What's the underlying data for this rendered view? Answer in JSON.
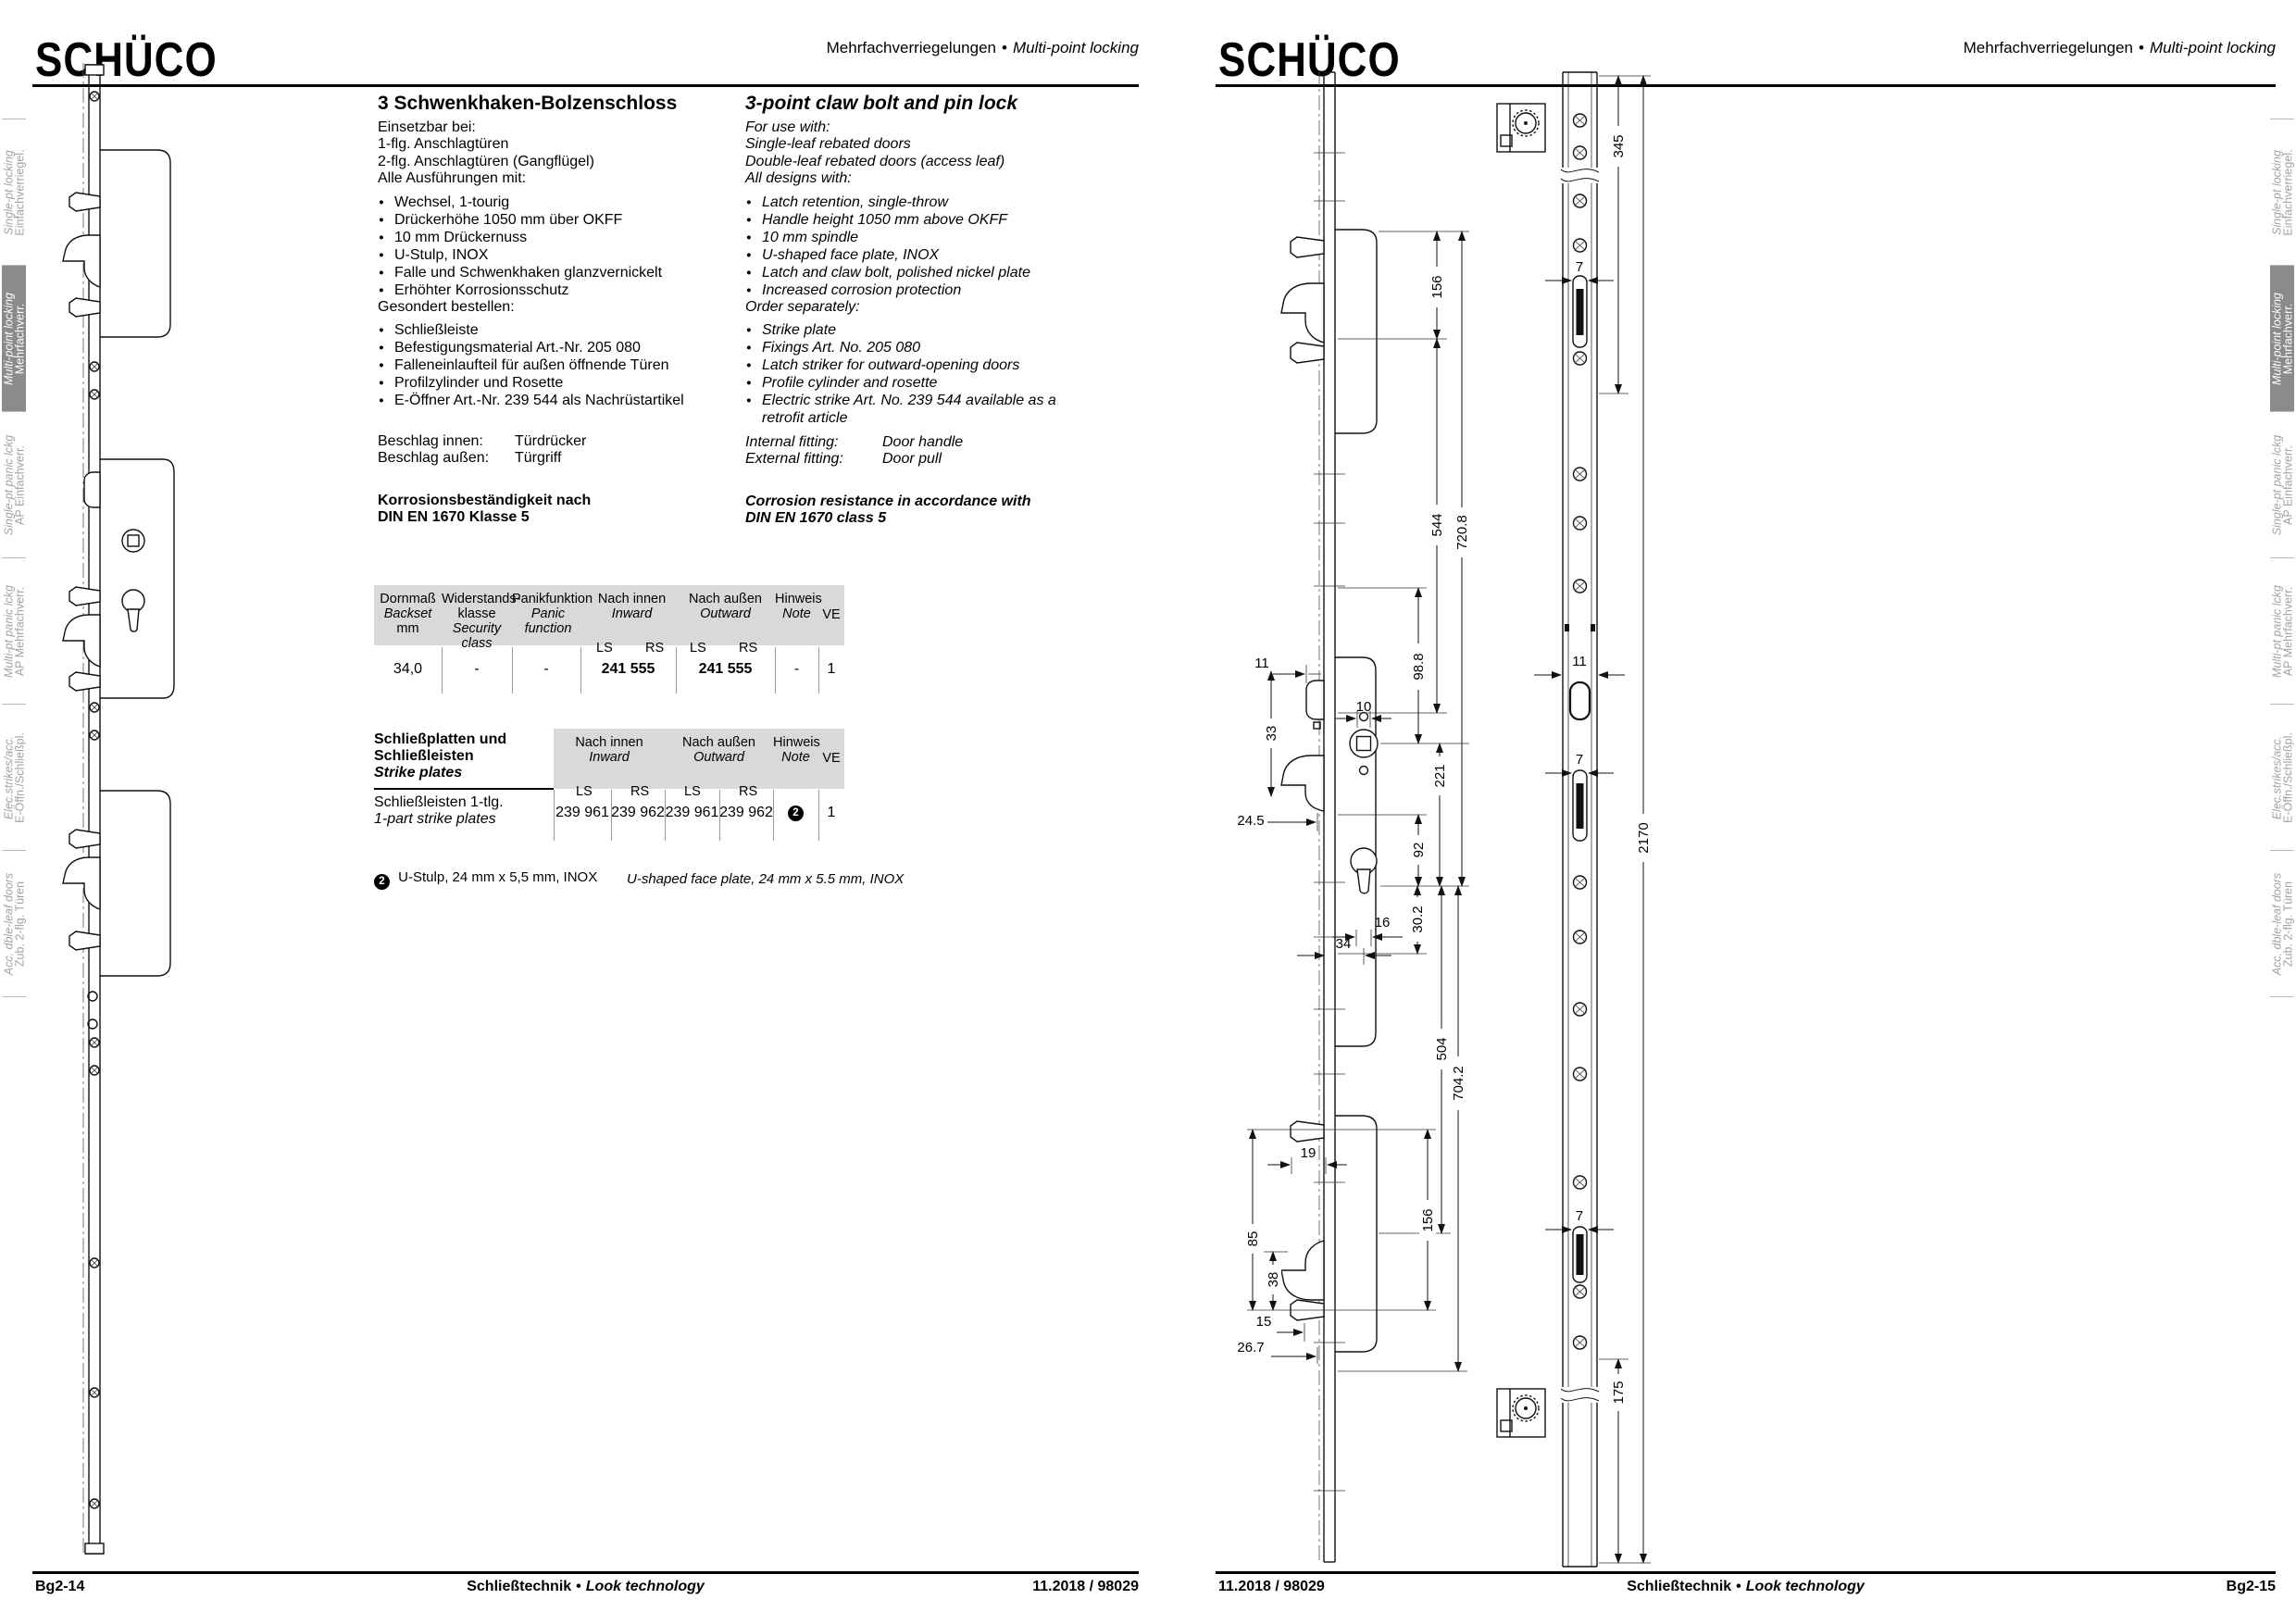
{
  "header": {
    "logo": "SCHÜCO",
    "subtitle_de": "Mehrfachverriegelungen",
    "sep": "•",
    "subtitle_en": "Multi-point locking"
  },
  "footer": {
    "page_left": "Bg2-14",
    "page_right": "Bg2-15",
    "center_de": "Schließtechnik",
    "sep": "•",
    "center_en": "Look technology",
    "code": "11.2018 / 98029"
  },
  "tabs": [
    {
      "en": "Single-pt locking",
      "de": "Einfachverriegel."
    },
    {
      "en": "Multi-point locking",
      "de": "Mehrfachverr."
    },
    {
      "en": "Single-pt panic lckg",
      "de": "AP Einfachverr."
    },
    {
      "en": "Multi-pt panic lckg",
      "de": "AP Mehrfachverr."
    },
    {
      "en": "Elec.strikes/acc.",
      "de": "E-Öffn./Schließpl."
    },
    {
      "en": "Acc. dble-leaf doors",
      "de": "Zub. 2-flg. Türen"
    }
  ],
  "product": {
    "de": {
      "title": "3 Schwenkhaken-Bolzenschloss",
      "intro": [
        "Einsetzbar bei:",
        "1-flg. Anschlagtüren",
        "2-flg. Anschlagtüren (Gangflügel)"
      ],
      "designs_heading": "Alle Ausführungen mit:",
      "designs": [
        "Wechsel, 1-tourig",
        "Drückerhöhe 1050 mm über OKFF",
        "10 mm Drückernuss",
        "U-Stulp, INOX",
        "Falle und Schwenkhaken glanzvernickelt",
        "Erhöhter Korrosionsschutz"
      ],
      "order_heading": "Gesondert bestellen:",
      "order": [
        "Schließleiste",
        "Befestigungsmaterial Art.-Nr. 205 080",
        "Falleneinlaufteil für außen öffnende Türen",
        "Profilzylinder und Rosette",
        "E-Öffner Art.-Nr. 239 544 als Nachrüstartikel"
      ],
      "fittings": [
        {
          "label": "Beschlag innen:",
          "value": "Türdrücker"
        },
        {
          "label": "Beschlag außen:",
          "value": "Türgriff"
        }
      ],
      "corrosion": [
        "Korrosionsbeständigkeit nach",
        "DIN EN 1670 Klasse 5"
      ]
    },
    "en": {
      "title": "3-point claw bolt and pin lock",
      "intro": [
        "For use with:",
        "Single-leaf rebated doors",
        "Double-leaf rebated doors (access leaf)"
      ],
      "designs_heading": "All designs with:",
      "designs": [
        "Latch retention, single-throw",
        "Handle height 1050 mm above OKFF",
        "10 mm spindle",
        "U-shaped face plate, INOX",
        "Latch and claw bolt, polished nickel plate",
        "Increased corrosion protection"
      ],
      "order_heading": "Order separately:",
      "order": [
        "Strike plate",
        "Fixings Art. No. 205 080",
        "Latch striker for outward-opening doors",
        "Profile cylinder and rosette",
        "Electric strike Art. No. 239 544 available as a retrofit article"
      ],
      "fittings": [
        {
          "label": "Internal fitting:",
          "value": "Door handle"
        },
        {
          "label": "External fitting:",
          "value": "Door pull"
        }
      ],
      "corrosion": [
        "Corrosion resistance in accordance with",
        "DIN EN 1670 class 5"
      ]
    }
  },
  "cols": {
    "inward_de": "Nach innen",
    "inward_en": "Inward",
    "outward_de": "Nach außen",
    "outward_en": "Outward",
    "note_de": "Hinweis",
    "note_en": "Note",
    "ve": "VE",
    "ls": "LS",
    "rs": "RS"
  },
  "table1": {
    "col1": [
      "Dornmaß",
      "Backset",
      "mm"
    ],
    "col2": [
      "Widerstands-",
      "klasse",
      "Security class"
    ],
    "col3": [
      "Panikfunktion",
      "Panic function"
    ],
    "row": {
      "backset": "34,0",
      "security": "-",
      "panic": "-",
      "inward": "241 555",
      "outward": "241 555",
      "note": "-",
      "ve": "1"
    }
  },
  "table2": {
    "title_de": "Schließplatten und Schließleisten",
    "title_en": "Strike plates",
    "row_de": "Schließleisten 1-tlg.",
    "row_en": "1-part strike plates",
    "v1": "239 961",
    "v2": "239 962",
    "v3": "239 961",
    "v4": "239 962",
    "note": "2",
    "ve": "1"
  },
  "footnote": {
    "marker": "2",
    "de": "U-Stulp, 24 mm x 5,5 mm, INOX",
    "en": "U-shaped face plate, 24 mm x 5.5 mm, INOX"
  },
  "dims": {
    "d345": "345",
    "d2170": "2170",
    "d175": "175",
    "d156": "156",
    "d544": "544",
    "d720_8": "720.8",
    "d704_2": "704.2",
    "d504": "504",
    "d221": "221",
    "d92": "92",
    "d98_8": "98.8",
    "d33": "33",
    "d10": "10",
    "d30_2": "30.2",
    "d16": "16",
    "d34": "34",
    "d24_5": "24.5",
    "d19": "19",
    "d85": "85",
    "d38": "38",
    "d15": "15",
    "d26_7": "26.7",
    "d11": "11",
    "d7": "7"
  }
}
